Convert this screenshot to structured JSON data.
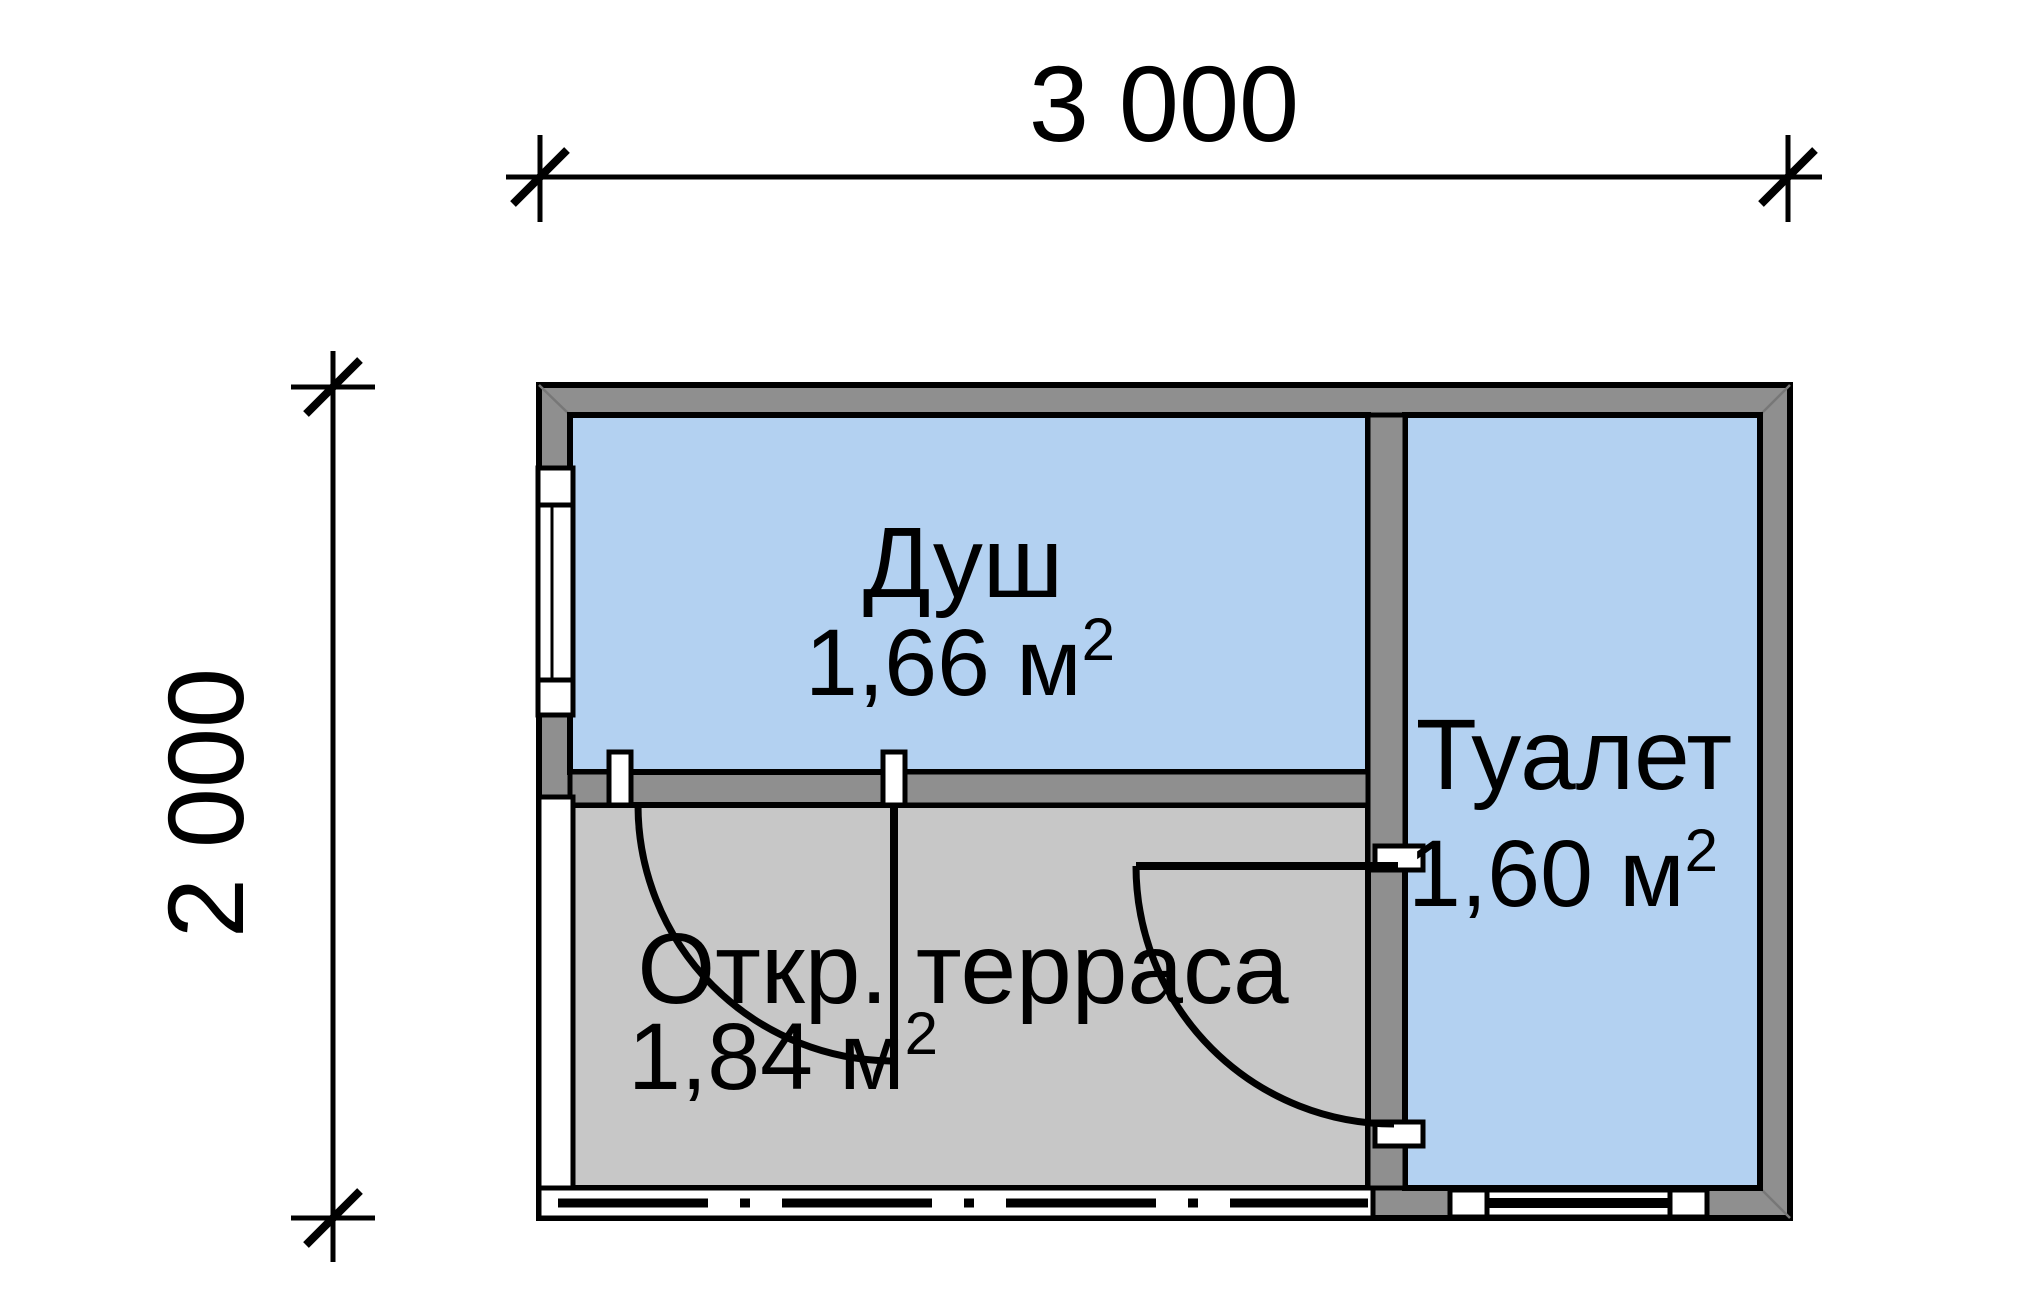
{
  "figure": {
    "type": "floor-plan"
  },
  "dimensions": {
    "horizontal_label": "3 000",
    "vertical_label": "2 000"
  },
  "rooms": {
    "shower": {
      "name": "Душ",
      "area_main": "1,66 м",
      "area_sup": "2"
    },
    "toilet": {
      "name": "Туалет",
      "area_main": "1,60 м",
      "area_sup": "2"
    },
    "terrace": {
      "name": "Откр. терраса",
      "area_main": "1,84 м",
      "area_sup": "2"
    }
  },
  "colors": {
    "room_fill": "#b3d1f1",
    "wall_fill": "#8f8f8f",
    "terrace_fill": "#c7c7c7",
    "line": "#000000",
    "background": "#ffffff"
  }
}
